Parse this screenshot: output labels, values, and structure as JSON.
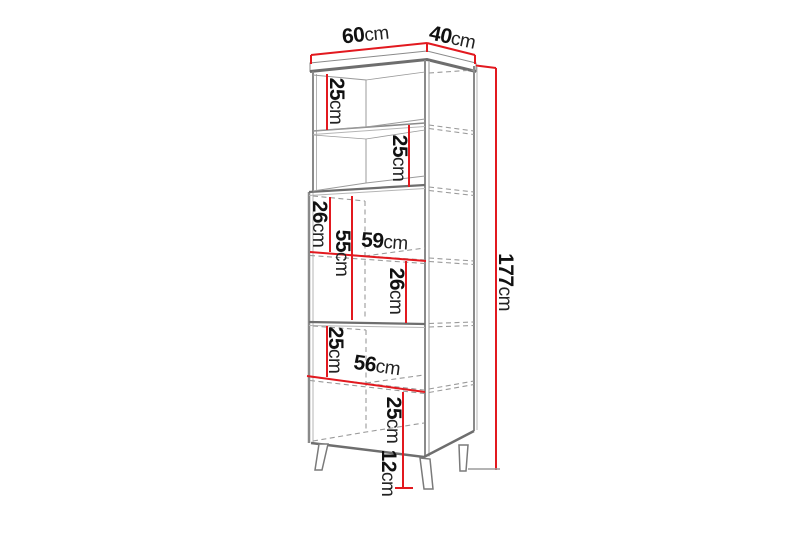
{
  "diagram": {
    "title": "Tall cabinet dimension diagram",
    "figure": "bookcase with two doors and four splayed legs, drawn in perspective",
    "unit": "cm",
    "dimensions": {
      "top_width": {
        "value": "60",
        "unit": "cm"
      },
      "top_depth": {
        "value": "40",
        "unit": "cm"
      },
      "shelf_top_a": {
        "value": "25",
        "unit": "cm"
      },
      "shelf_top_b": {
        "value": "25",
        "unit": "cm"
      },
      "shelf_mid_a": {
        "value": "26",
        "unit": "cm"
      },
      "door_height": {
        "value": "55",
        "unit": "cm"
      },
      "door_width": {
        "value": "59",
        "unit": "cm"
      },
      "shelf_mid_b": {
        "value": "26",
        "unit": "cm"
      },
      "shelf_low_a": {
        "value": "25",
        "unit": "cm"
      },
      "inner_width": {
        "value": "56",
        "unit": "cm"
      },
      "shelf_low_b": {
        "value": "25",
        "unit": "cm"
      },
      "total_height": {
        "value": "177",
        "unit": "cm"
      },
      "leg_height": {
        "value": "12",
        "unit": "cm"
      }
    },
    "colors": {
      "dimension_line": "#e2191f",
      "outline": "#8a8a8a",
      "label_text": "#111111",
      "background": "#ffffff"
    }
  }
}
